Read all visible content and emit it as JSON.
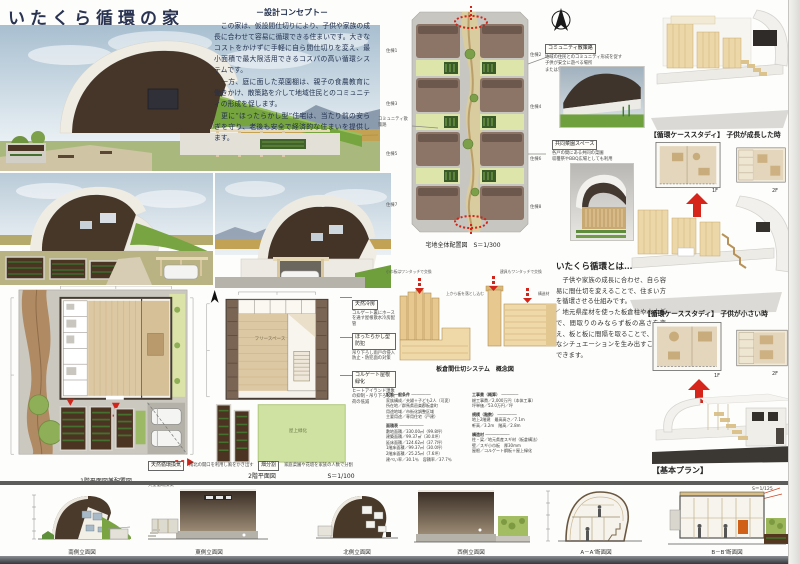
{
  "header": {
    "title": "いたくら循環の家"
  },
  "concept": {
    "heading": "－設計コンセプト－",
    "p1": "　この家は、仮設間仕切りにより、子供や家族の成長に合わせて容易に循環できる住まいです。大きなコストをかけずに手軽に自ら間仕切りを変え、最小面積で最大限活用できるコスパの高い循環システムです。",
    "p2": "　一方、庭に面した菜園棚は、親子の食農教育に働きかけ、散策路を介して地域住民とのコミュニティの形成を促します。",
    "p3": "　更に“ほったらかし型”住宅は、当たり前の安らぎを守り、老後も安全で経済的な住まいを提供します。"
  },
  "site": {
    "caption": "宅地全体配置図　S＝1/300",
    "units_left": [
      "住棟1",
      "住棟3",
      "住棟5",
      "住棟7"
    ],
    "units_right": [
      "住棟2",
      "住棟4",
      "住棟6",
      "住棟8"
    ],
    "path_label": "コミュニティ散策路"
  },
  "callouts": {
    "community": {
      "title": "コミュニティ散策路",
      "l1": "地域の住民とのコミュニティ形成を促す",
      "l2": "子供が安全に遊べる場所",
      "l3": "または雪置き場として使用"
    },
    "garden": {
      "title": "共同菜園スペース",
      "l1": "各戸の間にある共同の菜園",
      "l2": "収穫祭やBBQ広場としても利用"
    }
  },
  "cases": {
    "grown": {
      "label": "【循環ケーススタディ】 子供が成長した時",
      "f1": "1F",
      "f2": "2F"
    },
    "small": {
      "label": "【循環ケーススタディ】 子供が小さい時",
      "f1": "1F",
      "f2": "2F"
    },
    "basic": "【基本プラン】"
  },
  "itakura": {
    "heading": "いたくら循環とは…",
    "p1": "　子供や家族の成長に合わせ、自ら容易に間仕切を変えることで、住まい方を循環させる仕組みです。",
    "p2": "　地元県産材を使った板倉柱や小巾板で、間取りのみならず板の高さを変え、板と板に間隔を取ることで、様々なシチュエーションを生み出すことができます。"
  },
  "partition": {
    "caption": "板倉間仕切システム　概念図",
    "ann1": "小巾板はワンタッチで交換",
    "ann2": "上から板を落とし込む",
    "ann3": "建具もワンタッチで交換",
    "ann4": "構造材"
  },
  "specs": {
    "col1": [
      "設計一般条件 ────────",
      "家族構成／夫婦＋子ども2人（可変）",
      "所在地／群馬県邑楽郡板倉町",
      "用途地域／市街化調整区域",
      "主要用途／専用住宅（戸建）",
      "面積表 ──────────",
      "敷地面積／330.00㎡（99.8坪）",
      "建築面積／99.37㎡（30.0坪）",
      "延床面積／124.62㎡（37.7坪）",
      "1階床面積／99.37㎡（30.0坪）",
      "2階床面積／25.25㎡（7.6坪）",
      "建ぺい率／30.1％　容積率／37.7％"
    ],
    "col2": [
      "工事費（概算） ───────",
      "総工事費／2,000万円（本体工事）",
      "坪単価／53.0万円／坪",
      "規模（階数） ────────",
      "地上2階建　最高高さ／7.1m",
      "軒高／3.2m　階高／2.8m",
      "構造材 ──────────",
      "柱・梁／地元県産スギ材（板倉構法）",
      "壁／スギ小巾板　厚30mm",
      "屋根／コルゲート鋼板＋屋上緑化"
    ]
  },
  "plans": {
    "plan1f_caption": "1階平面図兼配置図",
    "plan2f_caption": "2階平面図",
    "plan_scale": "S＝1/100",
    "free_space": "フリースペース",
    "green_roof": "屋上緑化",
    "c_cooling_t": "天然冷房",
    "c_cooling_b": "コルゲート裏にホースを通す屋根散水冷房配管",
    "c_security_t": "ほったらかし型防犯",
    "c_security_b": "吊り下ろし雨戸の侵入防止・防犯面の対策",
    "c_greenroof_t": "コルゲート屋根緑化",
    "c_greenroof_b": "ヒートアイランド現象の抑制・吊り下ろし負荷の低減",
    "c_field_t": "畑分割",
    "c_field_b": "家庭菜園や花壇を家族の人数で分割",
    "c_vent_t": "天然循環換気",
    "c_vent_b": "南北の開口を利用し風をかき出す大型循環換気"
  },
  "elevations": {
    "captions": [
      "南側立面図",
      "東側立面図",
      "北側立面図",
      "西側立面図",
      "A－A’断面図",
      "B－B’断面図"
    ],
    "scale": "S＝1/125"
  },
  "colors": {
    "accent_red": "#d2251a",
    "roof_brown": "#46362a",
    "grass": "#74a23c",
    "wood": "#e2c78f"
  }
}
